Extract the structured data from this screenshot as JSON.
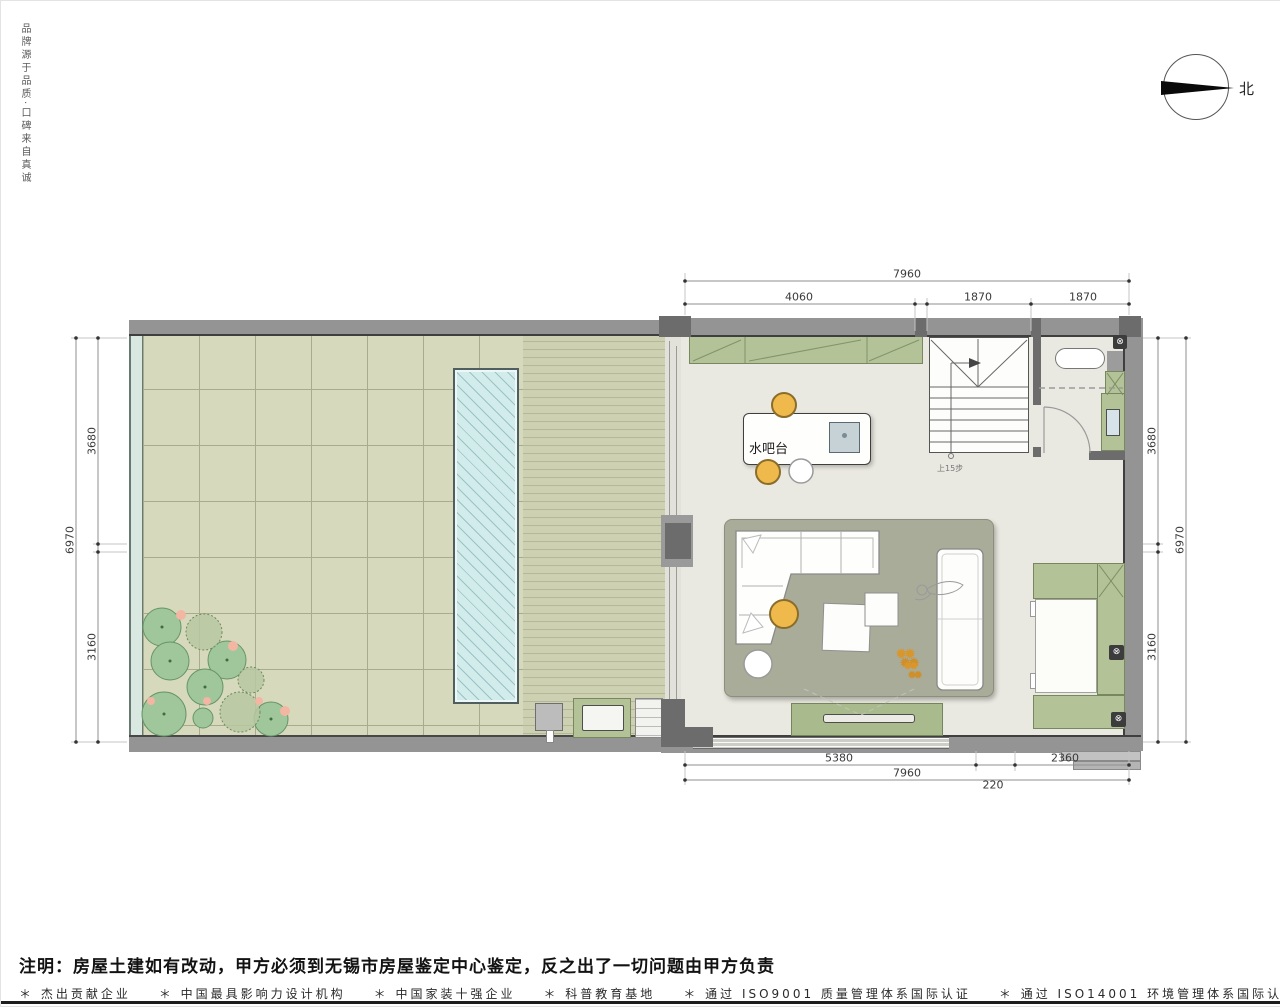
{
  "page": {
    "slogan": "品牌源于品质·口碑来自真诚",
    "compass_label": "北",
    "note": "注明：房屋土建如有改动，甲方必须到无锡市房屋鉴定中心鉴定，反之出了一切问题由甲方负责",
    "footer_items": [
      "＊ 杰出贡献企业",
      "＊ 中国最具影响力设计机构",
      "＊ 中国家装十强企业",
      "＊ 科普教育基地",
      "＊ 通过 ISO9001 质量管理体系国际认证",
      "＊ 通过 ISO14001 环境管理体系国际认证"
    ]
  },
  "plan": {
    "room_labels": {
      "water_bar": "水吧台",
      "stair_direction": "上15步"
    },
    "dimensions": {
      "top": {
        "overall": "7960",
        "segments": [
          "4060",
          "1870",
          "1870"
        ]
      },
      "bottom": {
        "overall": "7960",
        "segments": [
          "5380",
          "220",
          "2360"
        ]
      },
      "left": {
        "overall": "6970",
        "segments": [
          "3680",
          "3160"
        ]
      },
      "right": {
        "overall": "6970",
        "segments": [
          "3680",
          "3160"
        ]
      }
    },
    "colors": {
      "wall": "#949494",
      "tile_paving": "#d7d9bd",
      "wood_deck": "#cdd1b2",
      "pool_water": "#d2ebeb",
      "cabinet_green": "#b3c297",
      "rug": "#a9ac99",
      "stool_orange": "#f0b94b",
      "interior_floor": "#eae9e1"
    }
  }
}
